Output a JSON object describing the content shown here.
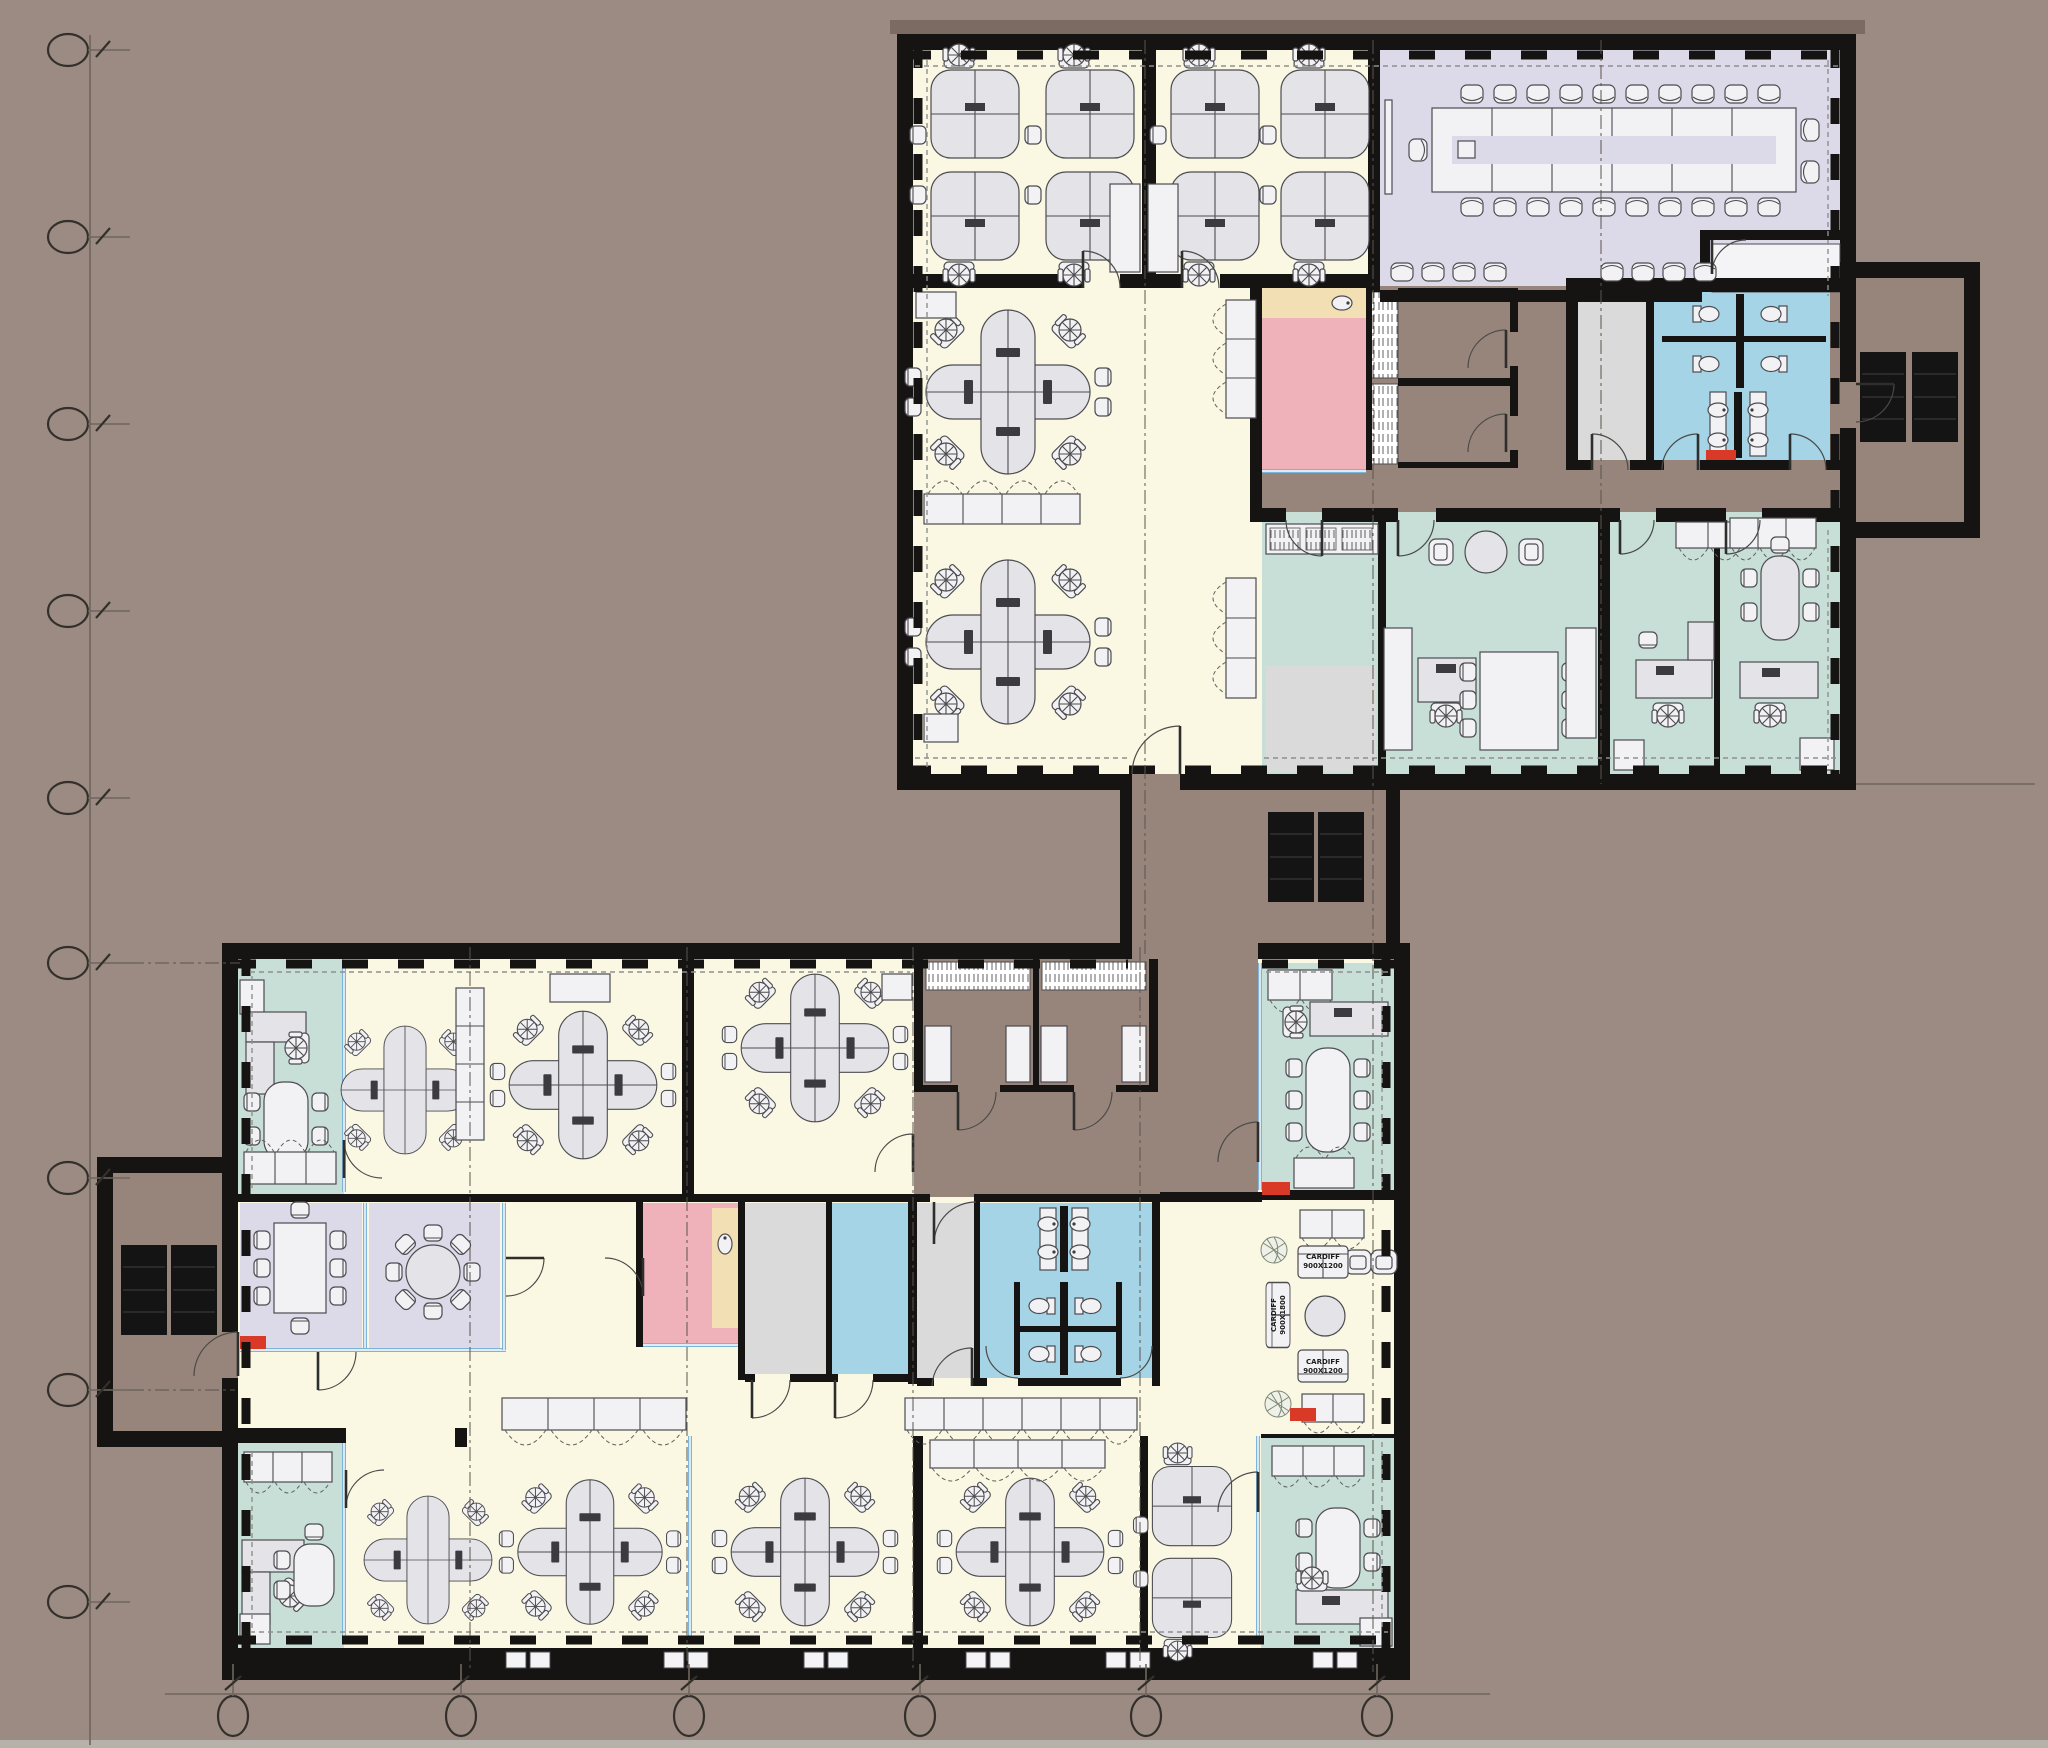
{
  "palette": {
    "background": "#9B8B82",
    "background_top": "#7B6B61",
    "corridor": "#97857B",
    "wall": "#151413",
    "cream": "#FAF7E3",
    "lavender": "#DCD9E9",
    "teal": "#C7DFD7",
    "pink": "#EFB2BB",
    "beige": "#F2DFB4",
    "blue": "#A5D4E6",
    "glass": "#7FB4D9",
    "gray_room": "#DADADA",
    "red": "#D93A27",
    "elevator": "#141414"
  },
  "labels": {
    "sofa_h1_l1": "CARDIFF",
    "sofa_h1_l2": "900X1200",
    "sofa_h2_l1": "CARDIFF",
    "sofa_h2_l2": "900X1200",
    "sofa_v_l1": "CARDIFF",
    "sofa_v_l2": "900X1800"
  },
  "grid_markers": {
    "left_count": 9,
    "bottom_count": 6
  }
}
